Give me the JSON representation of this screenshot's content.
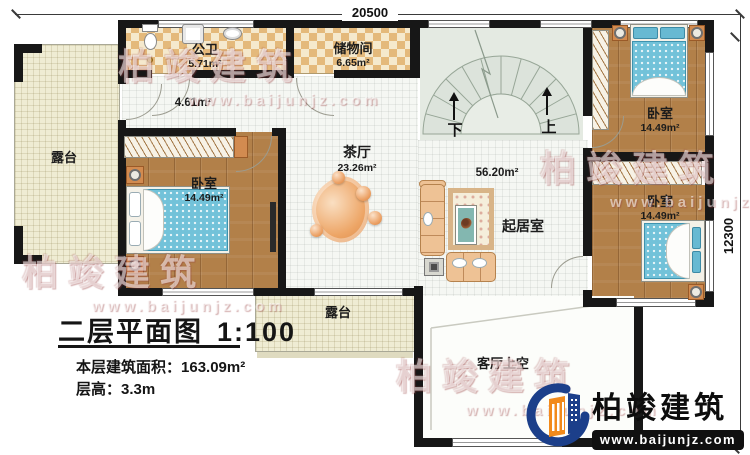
{
  "plan": {
    "dim_top": "20500",
    "dim_right": "12300"
  },
  "rooms": {
    "bathroom": {
      "name": "公卫",
      "area": "5.71m²"
    },
    "storage": {
      "name": "储物间",
      "area": "6.65m²"
    },
    "hallway": {
      "area": "4.61m²"
    },
    "tea_hall": {
      "name": "茶厅",
      "area": "23.26m²"
    },
    "bedroom_left": {
      "name": "卧室",
      "area": "14.49m²"
    },
    "bedroom_top_right": {
      "name": "卧室",
      "area": "14.49m²"
    },
    "bedroom_bottom_right": {
      "name": "卧室",
      "area": "14.49m²"
    },
    "living_room": {
      "name": "起居室",
      "area": "56.20m²"
    },
    "terrace_left": {
      "name": "露台"
    },
    "terrace_bottom": {
      "name": "露台"
    },
    "living_void": {
      "name": "客厅上空"
    }
  },
  "stairs": {
    "down": "下",
    "up": "上"
  },
  "title_block": {
    "title": "二层平面图",
    "scale": "1:100",
    "floor_area_label": "本层建筑面积：",
    "floor_area_value": "163.09m²",
    "floor_height_label": "层高：",
    "floor_height_value": "3.3m"
  },
  "branding": {
    "company": "柏竣建筑",
    "website": "www.baijunjz.com"
  },
  "watermark": {
    "company": "柏竣建筑",
    "website": "www.baijunjz.com"
  },
  "colors": {
    "wall": "#171717",
    "wood_floor": "#b28049",
    "tile_dark": "#e4b97b",
    "tile_light": "#f5e9cd",
    "terrace": "#efecd3",
    "stair": "#e4eae2",
    "bed_blue": "#72c2d9",
    "sofa": "#eec295",
    "rug_blob": "#eb9f62",
    "logo_blue": "#1c3f8a",
    "logo_orange": "#f28a1b"
  }
}
